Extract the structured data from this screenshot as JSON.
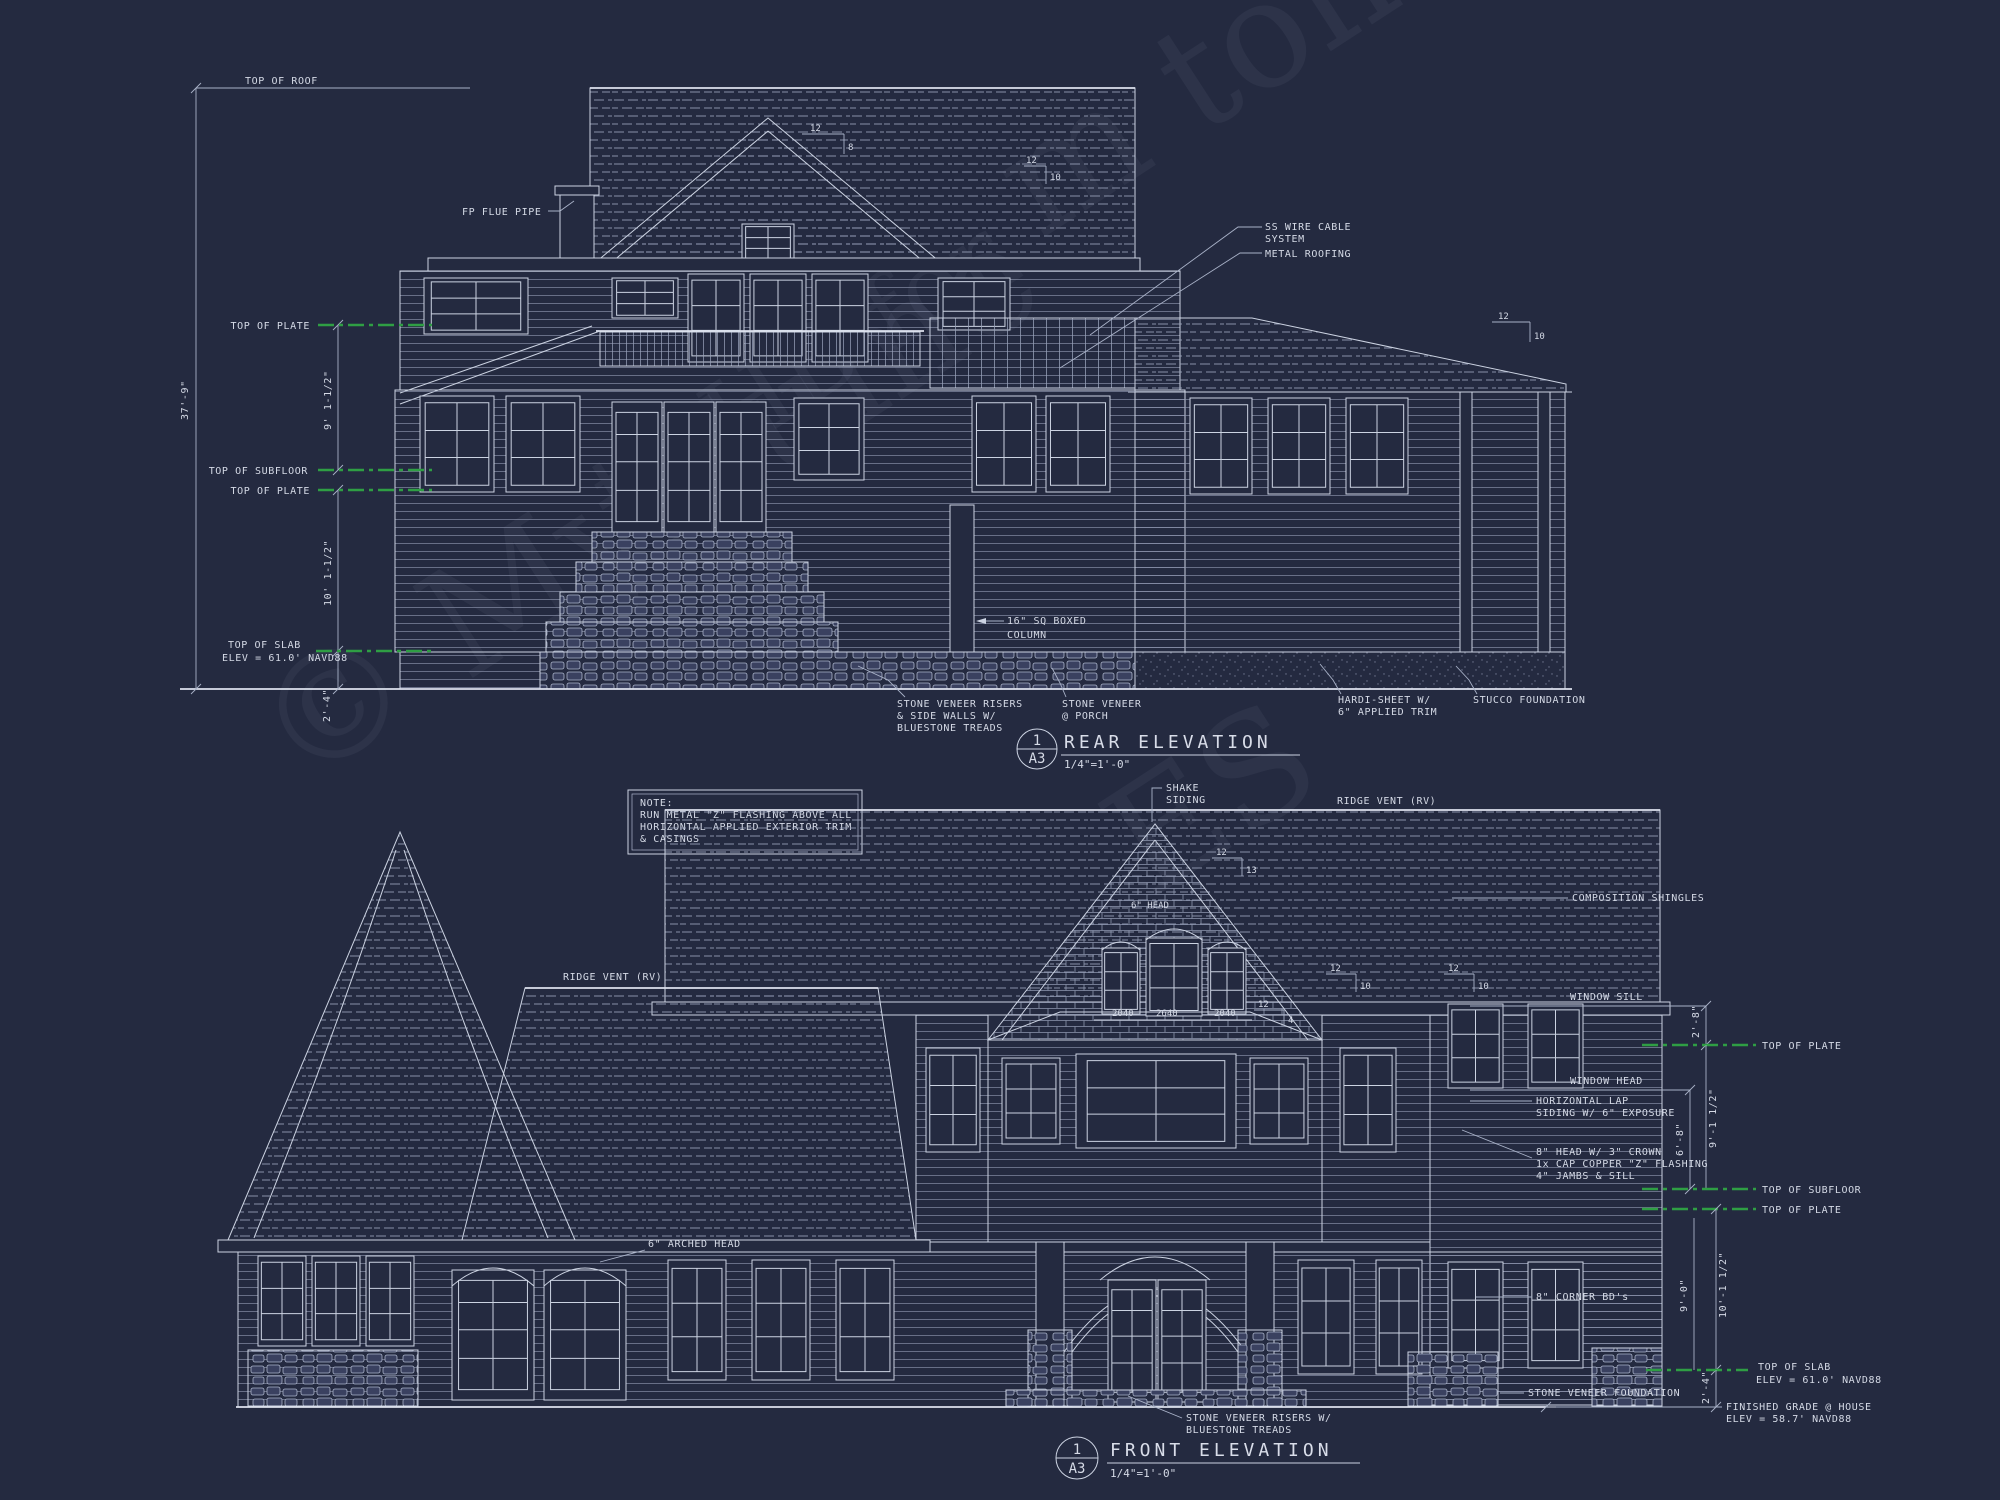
{
  "palette": {
    "background": "#242a40",
    "line": "#ccd3e2",
    "dim_line": "#a9b2c8",
    "datum_green": "#2f9e44",
    "text": "#d5dae6"
  },
  "watermark": {
    "fragments": [
      "© MyHume",
      "m ton",
      "to HB for",
      "ES"
    ]
  },
  "note_box": {
    "line1": "NOTE:",
    "line2": "RUN METAL \"Z\" FLASHING ABOVE ALL",
    "line3": "HORIZONTAL APPLIED EXTERIOR TRIM",
    "line4": "& CASINGS"
  },
  "rear": {
    "top_of_roof": "TOP OF ROOF",
    "fp_flue_pipe": "FP FLUE PIPE",
    "top_of_plate_upper": "TOP OF PLATE",
    "overall_height": "37'-9\"",
    "upper_story_height": "9' 1-1/2\"",
    "top_of_subfloor": "TOP OF SUBFLOOR",
    "top_of_plate_main": "TOP OF PLATE",
    "main_story_height": "10' 1-1/2\"",
    "top_of_slab": "TOP OF SLAB",
    "slab_elev": "ELEV = 61.0' NAVD88",
    "base_height": "2'-4\"",
    "ss_wire_line1": "SS WIRE CABLE",
    "ss_wire_line2": "SYSTEM",
    "metal_roofing": "METAL ROOFING",
    "boxed_column_line1": "16\" SQ BOXED",
    "boxed_column_line2": "COLUMN",
    "stone_risers_line1": "STONE VENEER RISERS",
    "stone_risers_line2": "& SIDE WALLS W/",
    "stone_risers_line3": "BLUESTONE TREADS",
    "stone_porch_line1": "STONE VENEER",
    "stone_porch_line2": "@ PORCH",
    "hardi_line1": "HARDI-SHEET W/",
    "hardi_line2": "6\" APPLIED TRIM",
    "stucco_foundation": "STUCCO FOUNDATION",
    "slope_ridge": {
      "rise": "12",
      "run": "10"
    },
    "slope_gable": {
      "rise": "12",
      "run": "8"
    },
    "slope_right": {
      "rise": "12",
      "run": "10"
    },
    "title": {
      "detail_number": "1",
      "sheet": "A3",
      "name": "REAR ELEVATION",
      "scale": "1/4\"=1'-0\""
    }
  },
  "front": {
    "ridge_vent_left": "RIDGE VENT (RV)",
    "ridge_vent_right": "RIDGE VENT (RV)",
    "shake_line1": "SHAKE",
    "shake_line2": "SIDING",
    "composition_shingles": "COMPOSITION SHINGLES",
    "window_sill": "WINDOW SILL",
    "sill_to_plate": "2'-8\"",
    "top_of_plate_upper": "TOP OF PLATE",
    "window_head": "WINDOW HEAD",
    "lap_line1": "HORIZONTAL LAP",
    "lap_line2": "SIDING W/ 6\" EXPOSURE",
    "head_to_subfloor": "6'-8\"",
    "upper_story_height": "9'-1 1/2\"",
    "trim_line1": "8\" HEAD W/ 3\" CROWN",
    "trim_line2": "1x CAP COPPER \"Z\" FLASHING",
    "trim_line3": "4\" JAMBS & SILL",
    "top_of_subfloor": "TOP OF SUBFLOOR",
    "top_of_plate_main": "TOP OF PLATE",
    "corner_boards": "8\" CORNER BD's",
    "ceiling_height": "9'-0\"",
    "main_story_height": "10'-1 1/2\"",
    "top_of_slab": "TOP OF SLAB",
    "slab_elev": "ELEV = 61.0' NAVD88",
    "stone_foundation": "STONE VENEER FOUNDATION",
    "base_height": "2'-4\"",
    "grade_line1": "FINISHED GRADE @ HOUSE",
    "grade_line2": "ELEV = 58.7' NAVD88",
    "arched_head": "6\" ARCHED HEAD",
    "gable_head": "6\" HEAD",
    "window_sizes": [
      "2040",
      "2640",
      "2040"
    ],
    "risers_line1": "STONE VENEER RISERS W/",
    "risers_line2": "BLUESTONE TREADS",
    "slope_gable": {
      "rise": "12",
      "run": "13"
    },
    "slope_bay": {
      "rise": "12",
      "run": "4"
    },
    "slope_right_a": {
      "rise": "12",
      "run": "10"
    },
    "slope_right_b": {
      "rise": "12",
      "run": "10"
    },
    "title": {
      "detail_number": "1",
      "sheet": "A3",
      "name": "FRONT ELEVATION",
      "scale": "1/4\"=1'-0\""
    }
  }
}
